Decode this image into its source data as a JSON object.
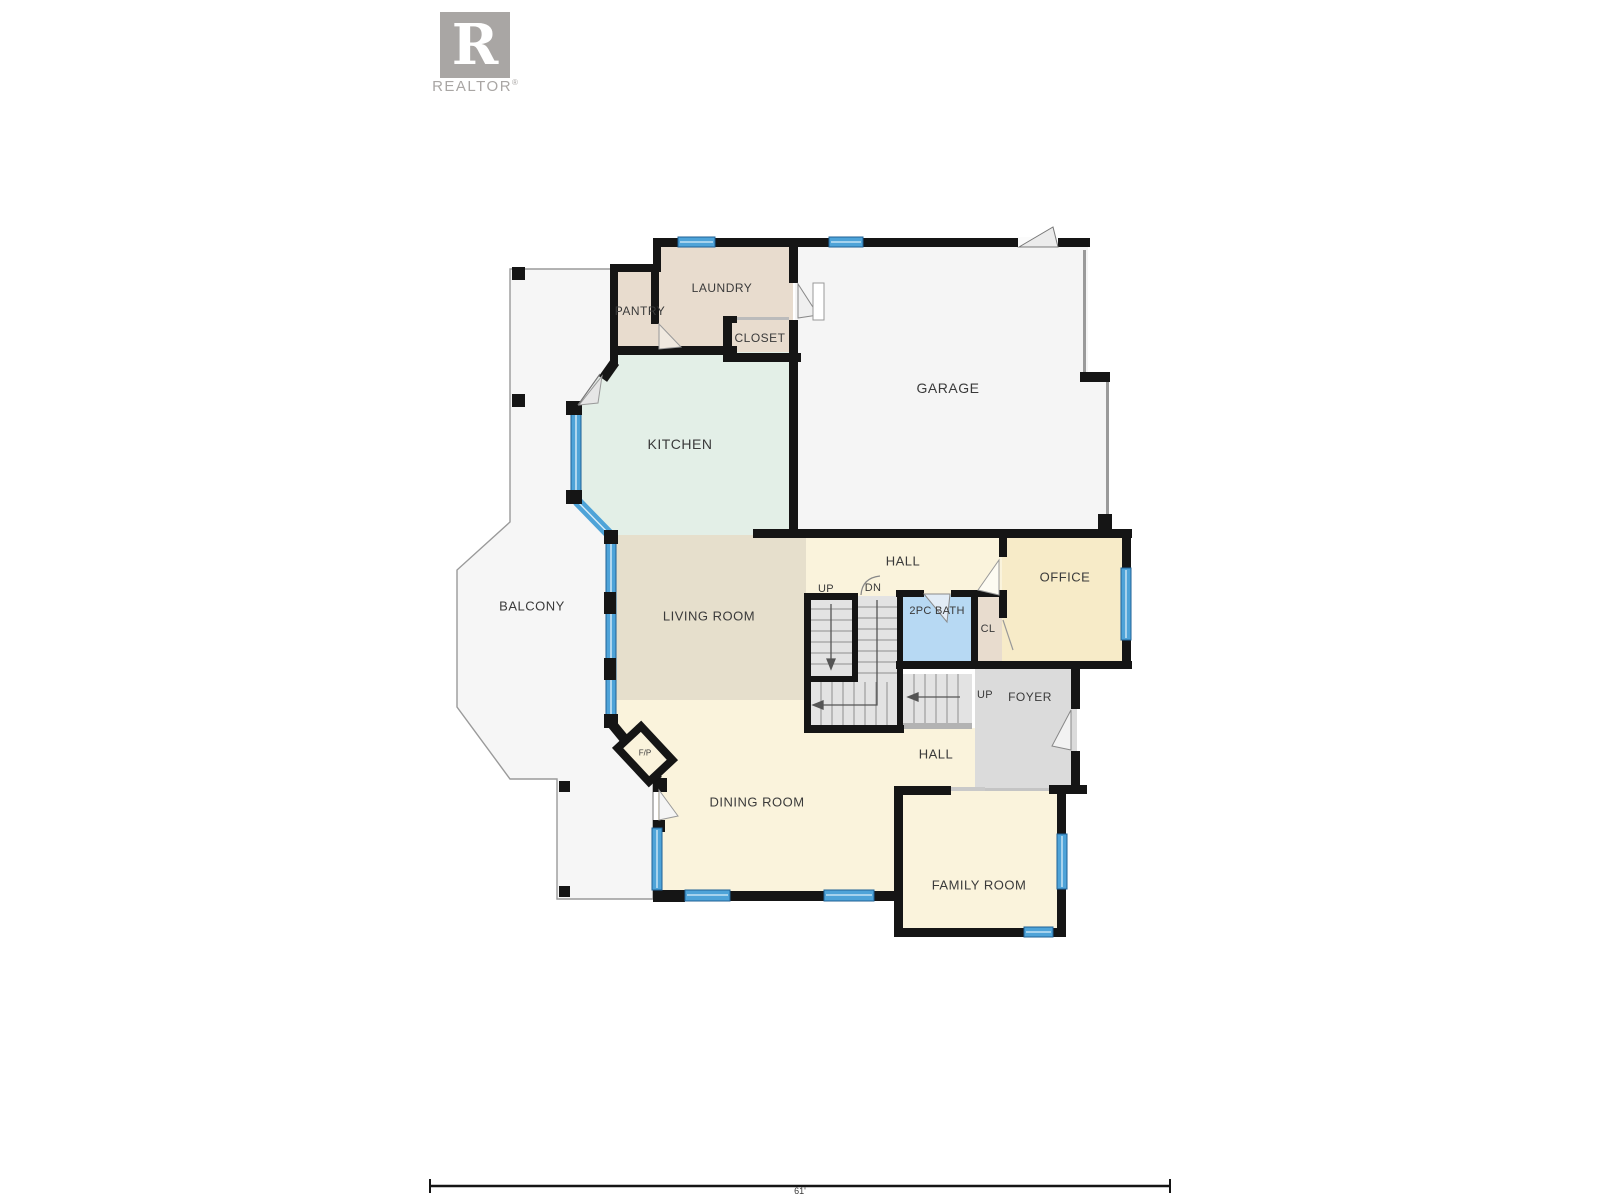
{
  "logo": {
    "letter": "R",
    "brand": "REALTOR",
    "registered_mark": "®"
  },
  "rooms": {
    "pantry": "PANTRY",
    "laundry": "LAUNDRY",
    "closet": "CLOSET",
    "garage": "GARAGE",
    "kitchen": "KITCHEN",
    "balcony": "BALCONY",
    "living_room": "LIVING ROOM",
    "hall_upper": "HALL",
    "hall_lower": "HALL",
    "office": "OFFICE",
    "bath": "2PC BATH",
    "closet_small": "CL",
    "foyer": "FOYER",
    "dining_room": "DINING ROOM",
    "family_room": "FAMILY ROOM",
    "fireplace": "F/P"
  },
  "stairs": {
    "up_back": "UP",
    "down": "DN",
    "up_front": "UP"
  },
  "scale_bar": {
    "label": "61'"
  },
  "colors": {
    "wall": "#151515",
    "window_fill": "#4ea3d8",
    "window_edge": "#1f6196",
    "kitchen": "#e3efe7",
    "tan_room": "#e8dcce",
    "cream_room": "#faf3dc",
    "office": "#f7ebc8",
    "living": "#e6dfcc",
    "bath": "#b7d9f3",
    "foyer": "#dbdbdb",
    "garage": "#f5f5f5",
    "stairs": "#e3e3e3",
    "balcony": "#f6f6f6",
    "logo_gray": "#a9a6a4"
  }
}
